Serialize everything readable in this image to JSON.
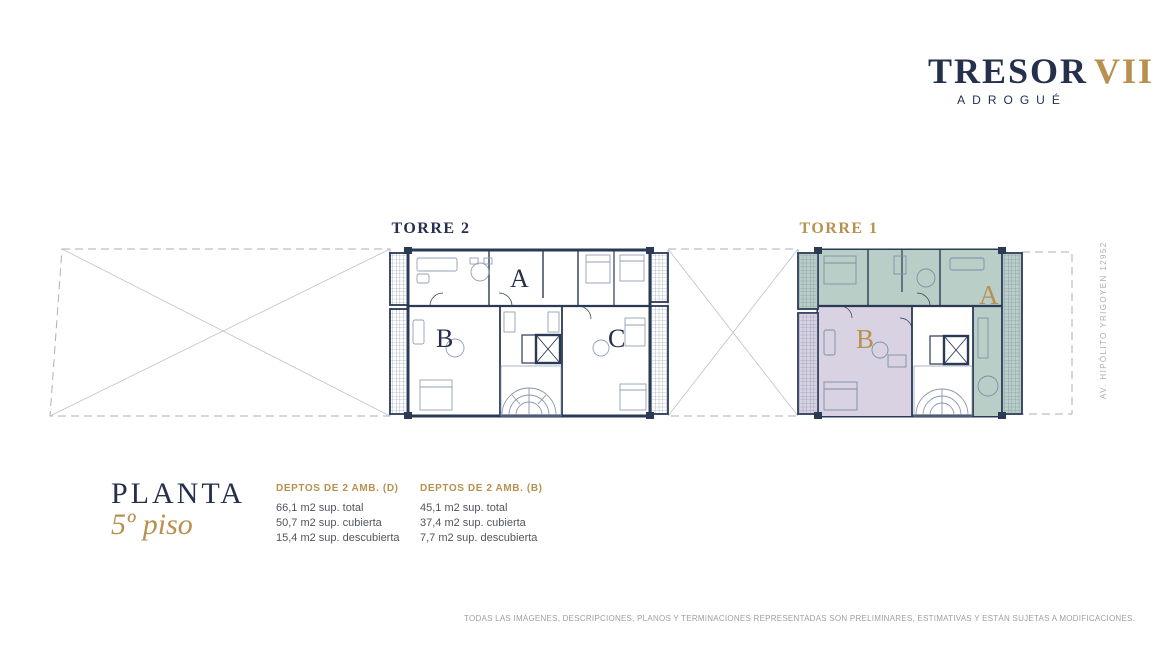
{
  "brand": {
    "name": "TRESOR",
    "numeral": "VII",
    "location": "ADROGUÉ"
  },
  "plan": {
    "title": "PLANTA",
    "subtitle": "5º piso",
    "street": "AV. HIPÓLITO YRIGOYEN 12952",
    "towers": [
      {
        "label": "TORRE 2",
        "units": [
          "A",
          "B",
          "C"
        ]
      },
      {
        "label": "TORRE 1",
        "units": [
          "A",
          "B"
        ]
      }
    ]
  },
  "specs": {
    "blocks": [
      {
        "title": "DEPTOS  DE 2 AMB. (D)",
        "lines": [
          "66,1 m2 sup. total",
          "50,7 m2 sup. cubierta",
          "15,4 m2 sup. descubierta"
        ]
      },
      {
        "title": "DEPTOS  DE 2 AMB. (B)",
        "lines": [
          "45,1 m2 sup. total",
          "37,4 m2 sup. cubierta",
          "7,7 m2 sup. descubierta"
        ]
      }
    ]
  },
  "footer": {
    "disclaimer": "TODAS LAS IMÁGENES, DESCRIPCIONES, PLANOS Y TERMINACIONES REPRESENTADAS SON PRELIMINARES, ESTIMATIVAS Y ESTÁN SUJETAS A MODIFICACIONES."
  },
  "colors": {
    "navy": "#25304d",
    "gold": "#b8904f",
    "wall": "#2a3a55",
    "unit_a_green": "#b9cec6",
    "unit_b_purple": "#d8d2e2",
    "muted_text": "#9aa0a6"
  }
}
